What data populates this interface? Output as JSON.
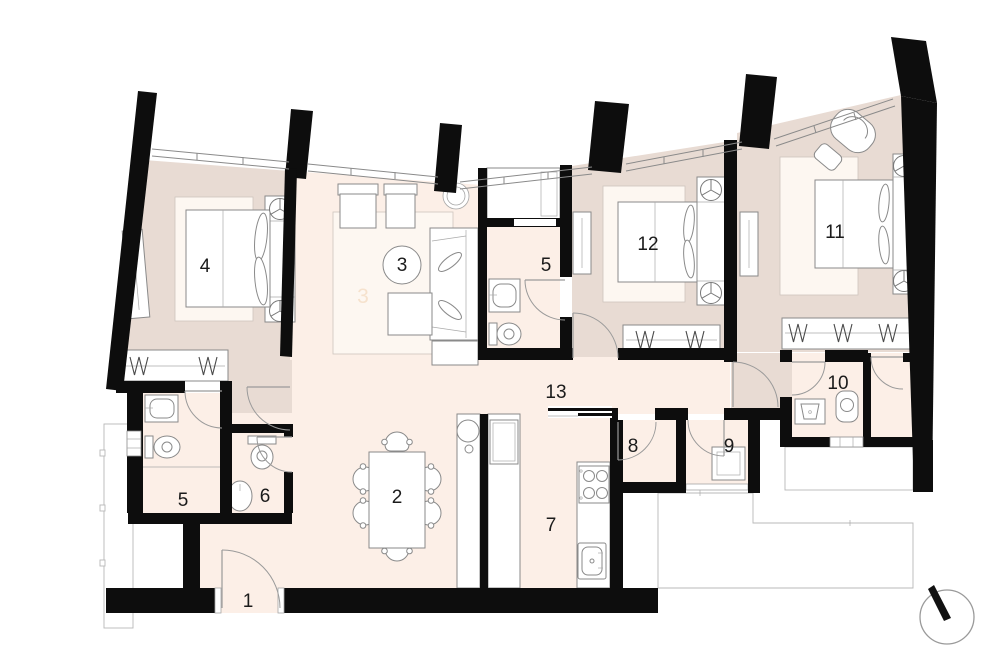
{
  "colors": {
    "wall": "#0d0d0d",
    "floor_bedroom": "#e8dbd3",
    "floor_main": "#fcefe7",
    "floor_rug": "#fdf7f1",
    "outline": "#8a8a8a"
  },
  "rooms": [
    {
      "label": "1"
    },
    {
      "label": "2"
    },
    {
      "label": "3"
    },
    {
      "label": "4"
    },
    {
      "label": "5"
    },
    {
      "label": "5"
    },
    {
      "label": "6"
    },
    {
      "label": "7"
    },
    {
      "label": "8"
    },
    {
      "label": "9"
    },
    {
      "label": "10"
    },
    {
      "label": "11"
    },
    {
      "label": "12"
    },
    {
      "label": "13"
    }
  ],
  "icons": {
    "compass": "north-indicator",
    "fan": "ceiling-fan",
    "hanger": "clothes-hanger"
  }
}
